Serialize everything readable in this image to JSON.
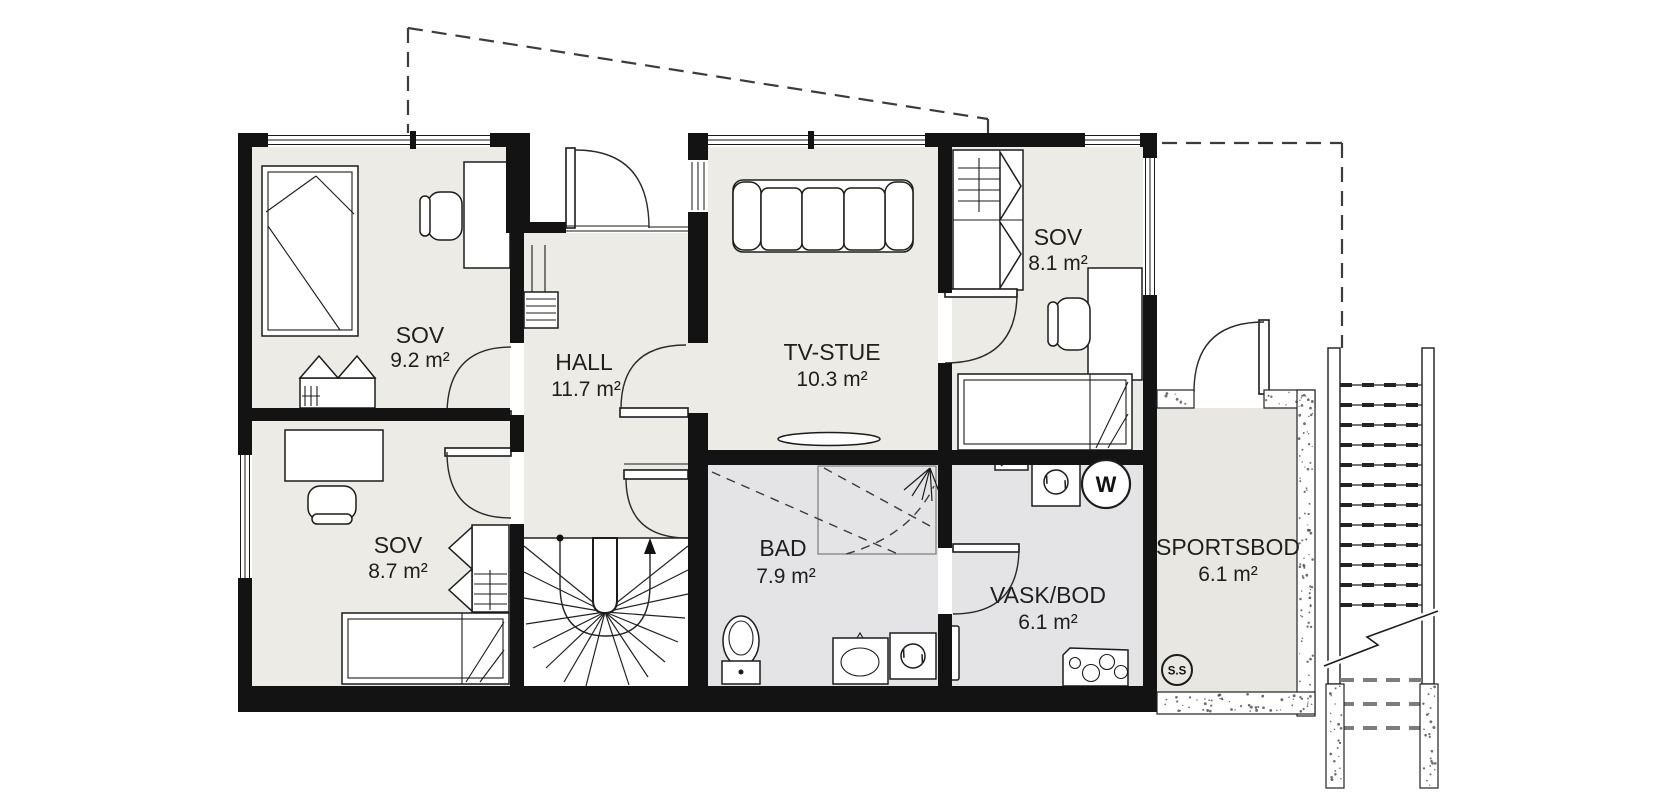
{
  "plan": {
    "type": "floorplan",
    "rooms": [
      {
        "id": "sov-9-2",
        "name": "SOV",
        "area": "9.2 m²"
      },
      {
        "id": "hall",
        "name": "HALL",
        "area": "11.7 m²"
      },
      {
        "id": "tv-stue",
        "name": "TV-STUE",
        "area": "10.3 m²"
      },
      {
        "id": "sov-8-1",
        "name": "SOV",
        "area": "8.1 m²"
      },
      {
        "id": "sov-8-7",
        "name": "SOV",
        "area": "8.7 m²"
      },
      {
        "id": "bad",
        "name": "BAD",
        "area": "7.9 m²"
      },
      {
        "id": "vask-bod",
        "name": "VASK/BOD",
        "area": "6.1 m²"
      },
      {
        "id": "sportsbod",
        "name": "SPORTSBOD",
        "area": "6.1 m²"
      }
    ],
    "markers": {
      "water_heater": "W",
      "stair_marker": "S.S"
    },
    "colors": {
      "wall": "#131313",
      "floor_dry": "#edebe5",
      "floor_wet": "#e4e4e7",
      "floor_storage": "#e9e7e1",
      "outside": "#ffffff"
    }
  }
}
